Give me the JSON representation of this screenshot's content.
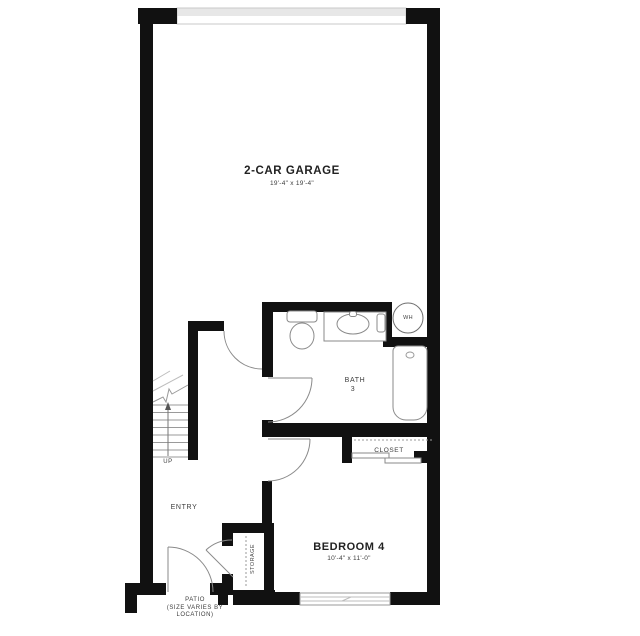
{
  "rooms": {
    "garage": {
      "name": "2-CAR GARAGE",
      "dims": "19'-4\" x 19'-4\""
    },
    "bath": {
      "name": "BATH",
      "number": "3"
    },
    "bedroom": {
      "name": "BEDROOM 4",
      "dims": "10'-4\" x 11'-0\""
    },
    "closet": {
      "name": "CLOSET"
    },
    "entry": {
      "name": "ENTRY"
    },
    "storage": {
      "name": "STORAGE"
    },
    "patio": {
      "name": "PATIO",
      "note_line1": "(SIZE VARIES BY",
      "note_line2": "LOCATION)"
    },
    "stairs": {
      "direction": "UP"
    },
    "water_heater": {
      "abbr": "WH"
    }
  },
  "colors": {
    "wall": "#111111",
    "fixture_line": "#8a8a8a",
    "text": "#3d3d3d"
  }
}
